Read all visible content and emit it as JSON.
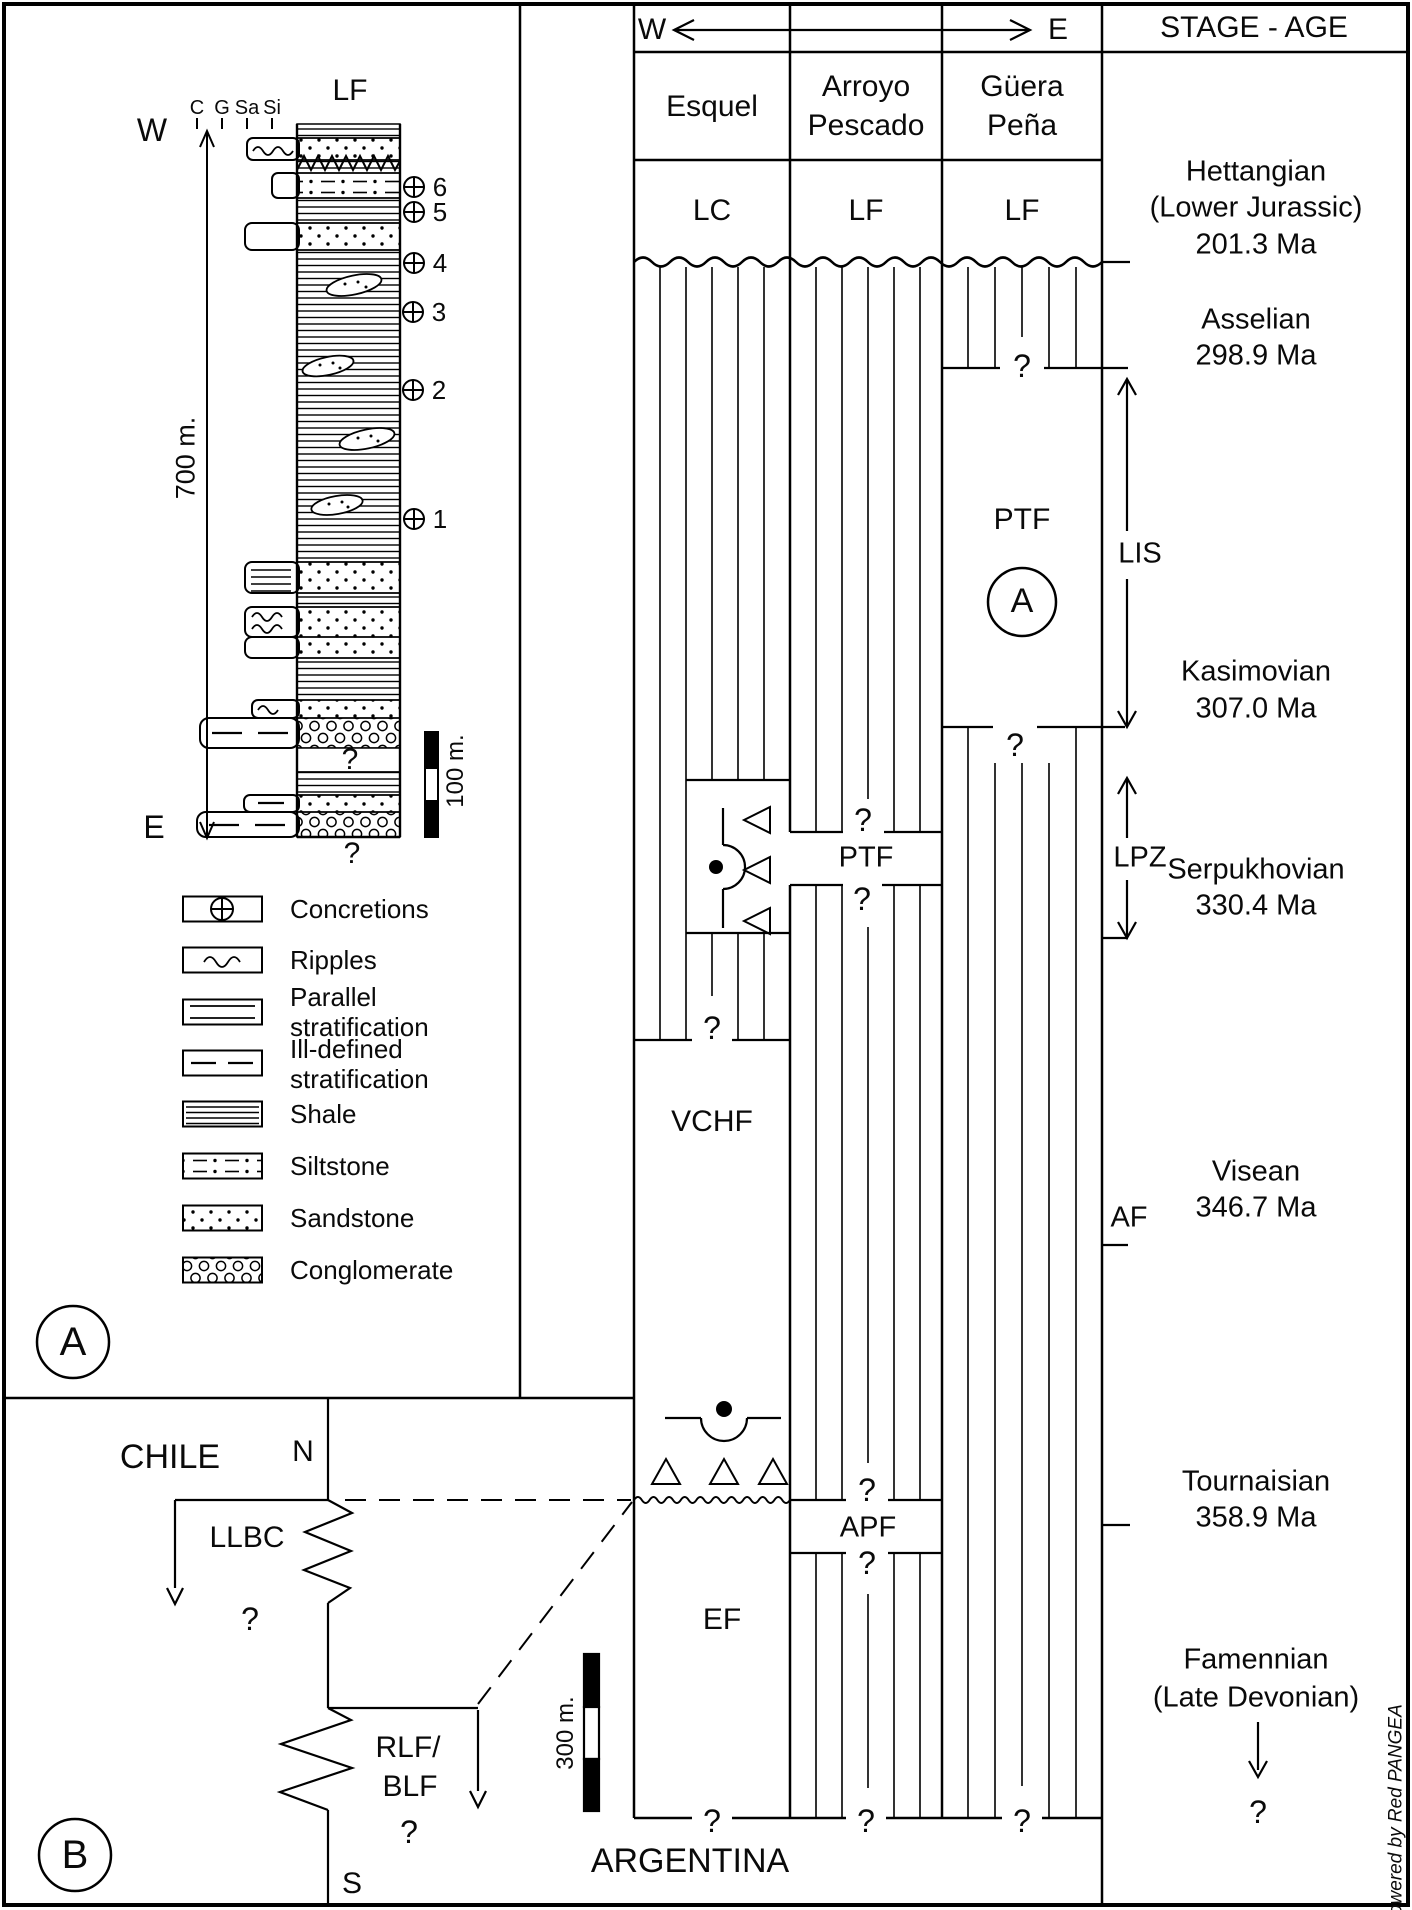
{
  "panel_a": {
    "badge": "A",
    "section": {
      "formation_top": "LF",
      "grain_sizes": [
        "C",
        "G",
        "Sa",
        "Si"
      ],
      "west": "W",
      "east": "E",
      "thickness": "700 m.",
      "scale": "100 m.",
      "concretion_numbers": [
        "1",
        "2",
        "3",
        "4",
        "5",
        "6"
      ],
      "gap_mark": "?",
      "base_mark": "?"
    },
    "legend": {
      "concretions": "Concretions",
      "ripples": "Ripples",
      "parallel_1": "Parallel",
      "parallel_2": "stratification",
      "ill_defined_1": "Ill-defined",
      "ill_defined_2": "stratification",
      "shale": "Shale",
      "siltstone": "Siltstone",
      "sandstone": "Sandstone",
      "conglomerate": "Conglomerate"
    }
  },
  "correlation": {
    "west": "W",
    "east": "E",
    "header": "STAGE - AGE",
    "columns": {
      "esquel": "Esquel",
      "arroyo_1": "Arroyo",
      "arroyo_2": "Pescado",
      "guera_1": "Güera",
      "guera_2": "Peña"
    },
    "units_top": {
      "esquel": "LC",
      "arroyo": "LF",
      "guera": "LF"
    },
    "formations": {
      "ptf_guera": "PTF",
      "panel_ref": "A",
      "ptf_mid": "PTF",
      "vchf": "VCHF",
      "ef": "EF",
      "apf": "APF",
      "lis": "LIS",
      "lpz": "LPZ",
      "af": "AF"
    },
    "q": "?",
    "stages": {
      "hettangian": {
        "name": "Hettangian",
        "sub": "(Lower Jurassic)",
        "age": "201.3 Ma"
      },
      "asselian": {
        "name": "Asselian",
        "age": "298.9 Ma"
      },
      "kasimovian": {
        "name": "Kasimovian",
        "age": "307.0 Ma"
      },
      "serpukhovian": {
        "name": "Serpukhovian",
        "age": "330.4 Ma"
      },
      "visean": {
        "name": "Visean",
        "age": "346.7 Ma"
      },
      "tournaisian": {
        "name": "Tournaisian",
        "age": "358.9 Ma"
      },
      "famennian": {
        "name": "Famennian",
        "sub": "(Late Devonian)",
        "mark": "?"
      }
    },
    "scale": "300 m.",
    "country": "ARGENTINA"
  },
  "panel_b": {
    "badge": "B",
    "north": "N",
    "south": "S",
    "country": "CHILE",
    "llbc": "LLBC",
    "llbc_mark": "?",
    "rlf_1": "RLF/",
    "rlf_2": "BLF",
    "rlf_mark": "?"
  },
  "credit": "Powered by Red PANGEA"
}
